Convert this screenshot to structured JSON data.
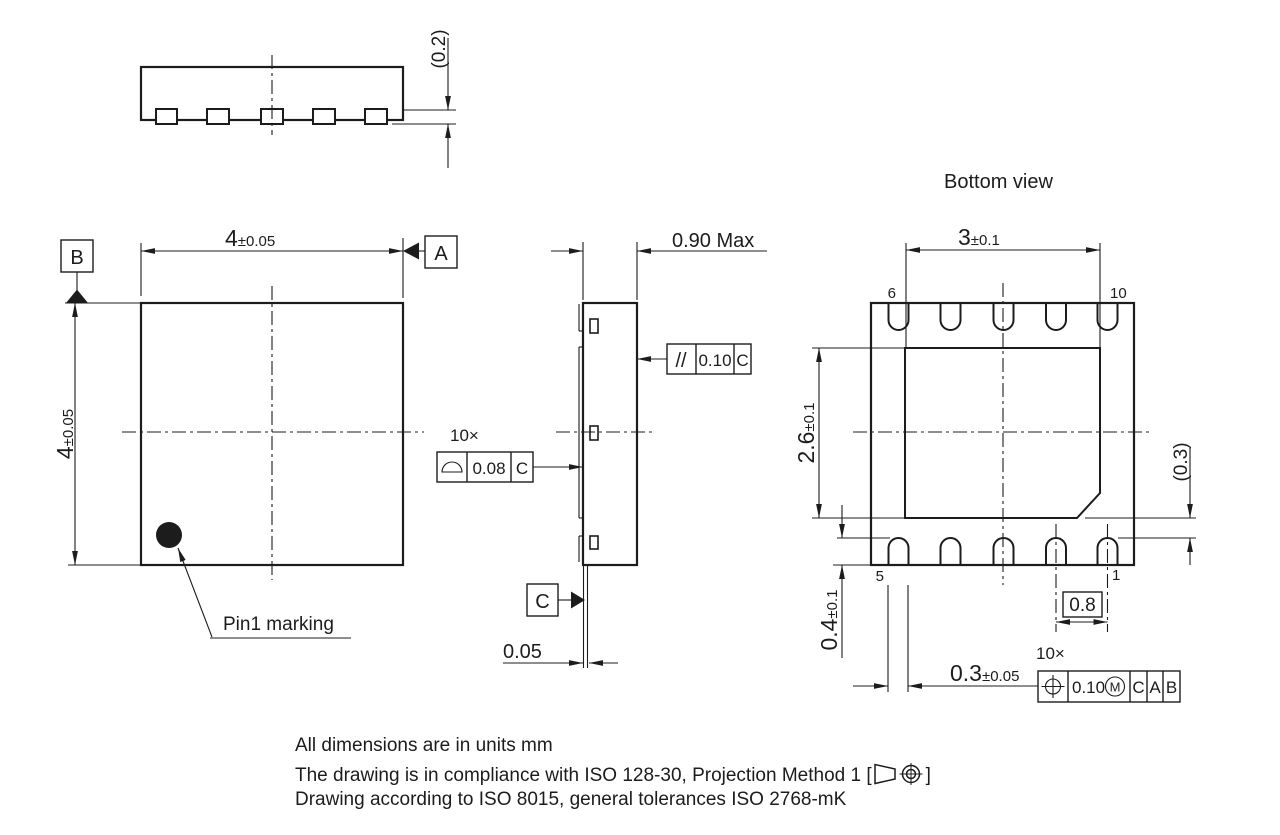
{
  "colors": {
    "ink": "#1c1c1c",
    "background": "#ffffff"
  },
  "top_side_view": {
    "lead_thickness": "(0.2)"
  },
  "top_view": {
    "width_value": "4",
    "width_tol": "±0.05",
    "height_value": "4",
    "height_tol": "±0.05",
    "datum_a": "A",
    "datum_b": "B",
    "pin1_label": "Pin1 marking"
  },
  "side_view": {
    "height_max": "0.90 Max",
    "parallelism": {
      "symbol": "//",
      "tolerance": "0.10",
      "datum": "C"
    },
    "profile": {
      "count": "10×",
      "symbol_icon": "profile-of-surface",
      "tolerance": "0.08",
      "datum": "C"
    },
    "datum_c": "C",
    "standoff": "0.05"
  },
  "bottom_view": {
    "title": "Bottom view",
    "pin_numbers": {
      "top_left": "6",
      "top_right": "10",
      "bottom_left": "5",
      "bottom_right": "1"
    },
    "pad_width_value": "3",
    "pad_width_tol": "±0.1",
    "pad_height_value": "2.6",
    "pad_height_tol": "±0.1",
    "pad_to_pin_gap": "(0.3)",
    "pin_length_value": "0.4",
    "pin_length_tol": "±0.1",
    "pin_pitch": "0.8",
    "pin_width_value": "0.3",
    "pin_width_tol": "±0.05",
    "position": {
      "count": "10×",
      "symbol_icon": "true-position",
      "tolerance": "0.10",
      "modifier": "M",
      "datum_1": "C",
      "datum_2": "A",
      "datum_3": "B"
    }
  },
  "notes": {
    "line1": "All dimensions are in units mm",
    "line2_prefix": "The drawing is in compliance with ISO 128-30, Projection Method 1 [",
    "line2_symbol_icon": "first-angle-projection",
    "line2_suffix": "]",
    "line3": "Drawing according to ISO 8015, general tolerances ISO 2768-mK"
  }
}
